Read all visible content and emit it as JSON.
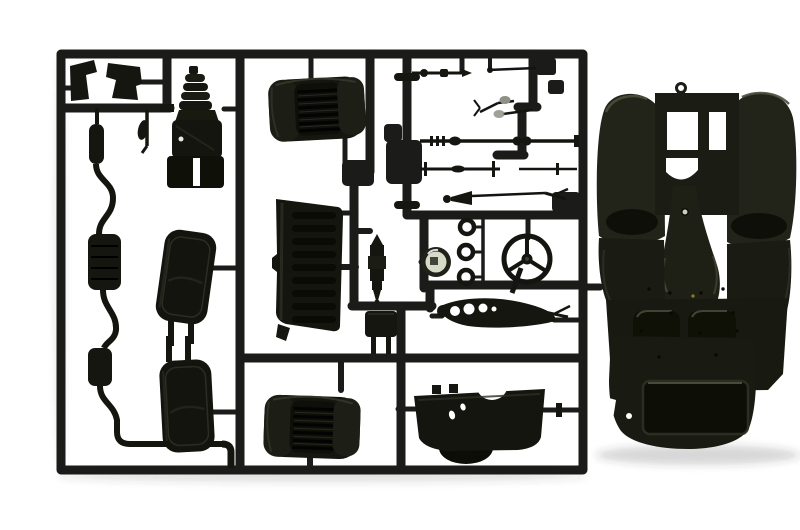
{
  "scene": {
    "type": "photograph",
    "subject": "Black injection-molded plastic model car kit sprue (parts tree) with a large chassis floor-pan part attached at the right, on a white background"
  },
  "colors": {
    "background": "#ffffff",
    "sprue_plastic": "#1b1b19",
    "part_plastic": "#15160f",
    "chassis_plastic": "#21231a",
    "chassis_shadow": "#101107",
    "chassis_highlight": "#454a38",
    "clear_lens": "#d6dbc8",
    "metal_link": "#8f9086",
    "photo_shadow": "#3a3a36"
  },
  "parts": [
    {
      "id": "sprue-frame",
      "label": "Sprue frame and runners"
    },
    {
      "id": "foot-pedals",
      "label": "Foot pedal plates"
    },
    {
      "id": "gear-lever",
      "label": "Gear lever"
    },
    {
      "id": "engine-block",
      "label": "Engine and gearbox block"
    },
    {
      "id": "bucket-seat-top",
      "label": "Bucket seat (upper)"
    },
    {
      "id": "bucket-seat-bottom",
      "label": "Bucket seat (lower)"
    },
    {
      "id": "exhaust-system",
      "label": "Exhaust pipe with mufflers"
    },
    {
      "id": "door-panel-upper",
      "label": "Door interior panel (upper)"
    },
    {
      "id": "door-panel-lower",
      "label": "Door interior panel (lower)"
    },
    {
      "id": "bulkhead-panel",
      "label": "Ribbed bulkhead panel"
    },
    {
      "id": "shock-absorber",
      "label": "Shock absorber"
    },
    {
      "id": "battery-box",
      "label": "Battery box"
    },
    {
      "id": "clear-lens",
      "label": "Clear lens insert"
    },
    {
      "id": "mount-rings",
      "label": "Mounting rings"
    },
    {
      "id": "steering-wheel",
      "label": "Steering wheel"
    },
    {
      "id": "exhaust-manifold",
      "label": "Exhaust manifold with ports"
    },
    {
      "id": "dashboard-cowl",
      "label": "Dashboard cowl"
    },
    {
      "id": "suspension-rods",
      "label": "Suspension rods and linkages"
    },
    {
      "id": "drive-shaft",
      "label": "Drive shaft"
    },
    {
      "id": "front-axle",
      "label": "Front axle rod"
    },
    {
      "id": "tail-pipe",
      "label": "Exhaust tail pipe cone"
    },
    {
      "id": "chassis-floorpan",
      "label": "Chassis floor pan"
    }
  ]
}
